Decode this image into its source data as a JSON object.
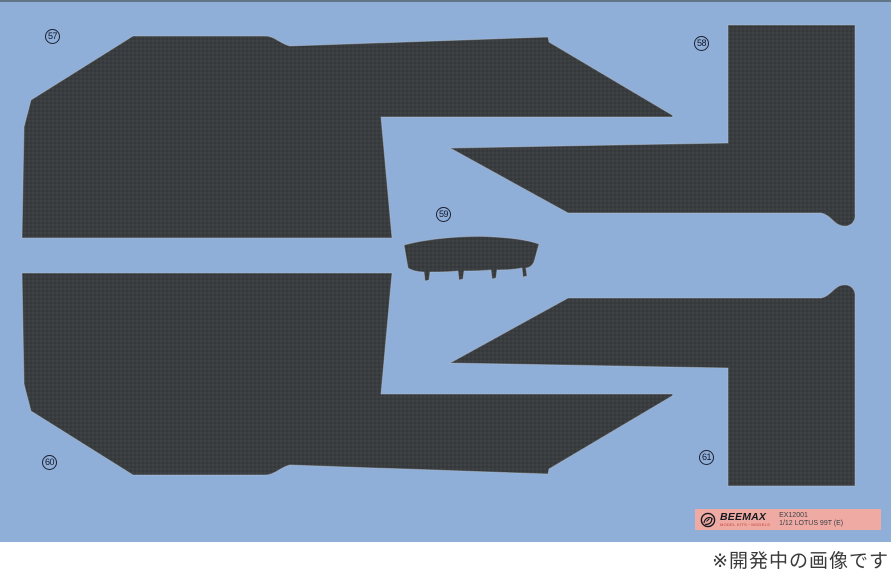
{
  "colors": {
    "sheet_blue": "#8fafd8",
    "sheet_edge": "#52606e",
    "carbon_base": "#3a3d40",
    "carbon_dot_light": "#474b4e",
    "carbon_dot_dark": "#2e3134",
    "label_pink": "#efaba3",
    "brand_dark": "#16181f",
    "brand_red": "#c0392e",
    "code_text": "#3c3f48",
    "note_text": "#3a3a3a",
    "circle_line": "#1b2030"
  },
  "parts": [
    {
      "number": "57"
    },
    {
      "number": "58"
    },
    {
      "number": "59"
    },
    {
      "number": "60"
    },
    {
      "number": "61"
    }
  ],
  "label": {
    "brand": "BEEMAX",
    "brand_subtitle": "MODEL KITS・MODELS",
    "product_code": "EX12001",
    "product_name": "1/12 LOTUS 99T (E)"
  },
  "footer": {
    "note": "※開発中の画像です"
  }
}
